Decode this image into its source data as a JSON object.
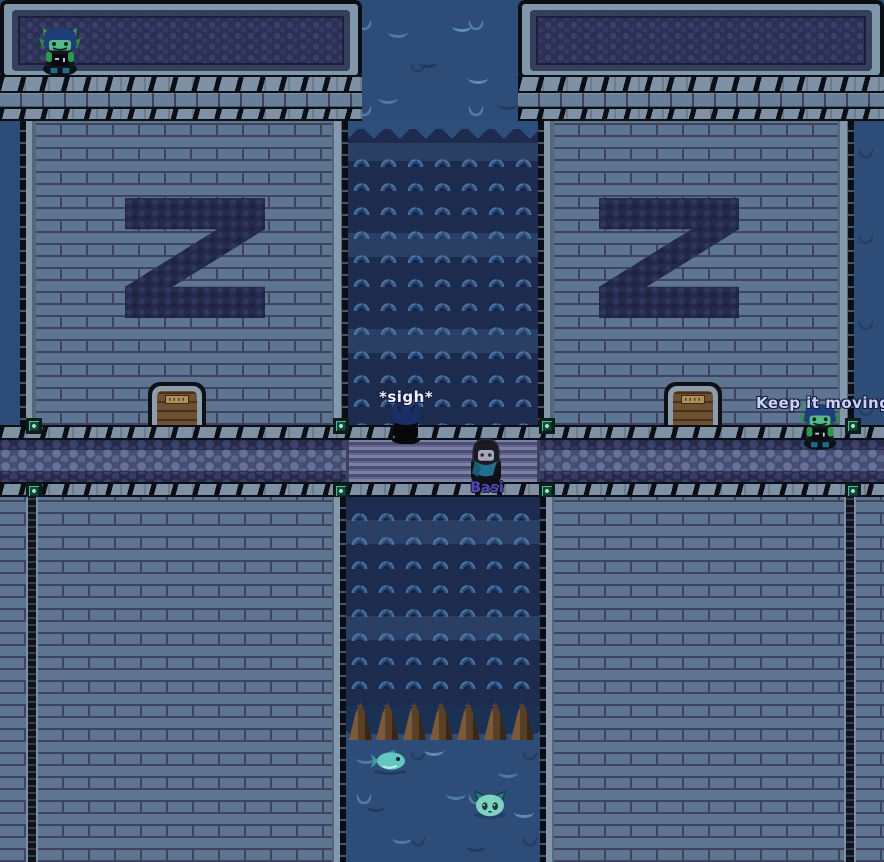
{
  "scene": {
    "emblem_letter": "Z"
  },
  "speech": {
    "sigh": "*sigh*",
    "keep_it_moving": "Keep it moving"
  },
  "characters": {
    "basi_name": "Basi"
  },
  "entities": {
    "left_guard": "lizard-guard",
    "right_guard": "lizard-guard",
    "player": "blue-haired-player",
    "basi": "hooded-npc",
    "fish": "fish",
    "cat": "water-cat"
  },
  "colors": {
    "water": "#2d4c77",
    "brick": "#5d7590",
    "mortar": "#3e445f",
    "waterfall": "#1d2c4e",
    "emblem": "#242a49",
    "speech_text": "#c9d3f8",
    "name_label": "#5646b2"
  }
}
